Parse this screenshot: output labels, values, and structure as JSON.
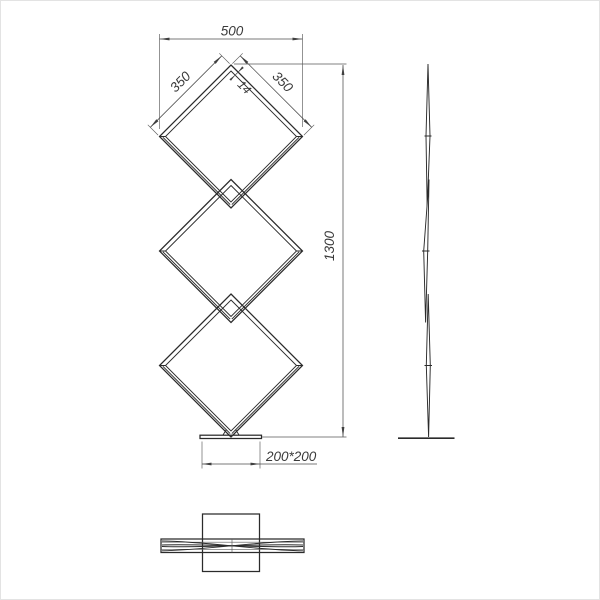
{
  "drawing": {
    "ink_color": "#2b2b2b",
    "dimension_color": "#4d4d4d",
    "background_color": "#ffffff",
    "dimensions": {
      "top_width": "500",
      "left_side": "350",
      "right_side": "350",
      "frame_width": "14",
      "total_height": "1300",
      "base_plate": "200*200"
    }
  }
}
